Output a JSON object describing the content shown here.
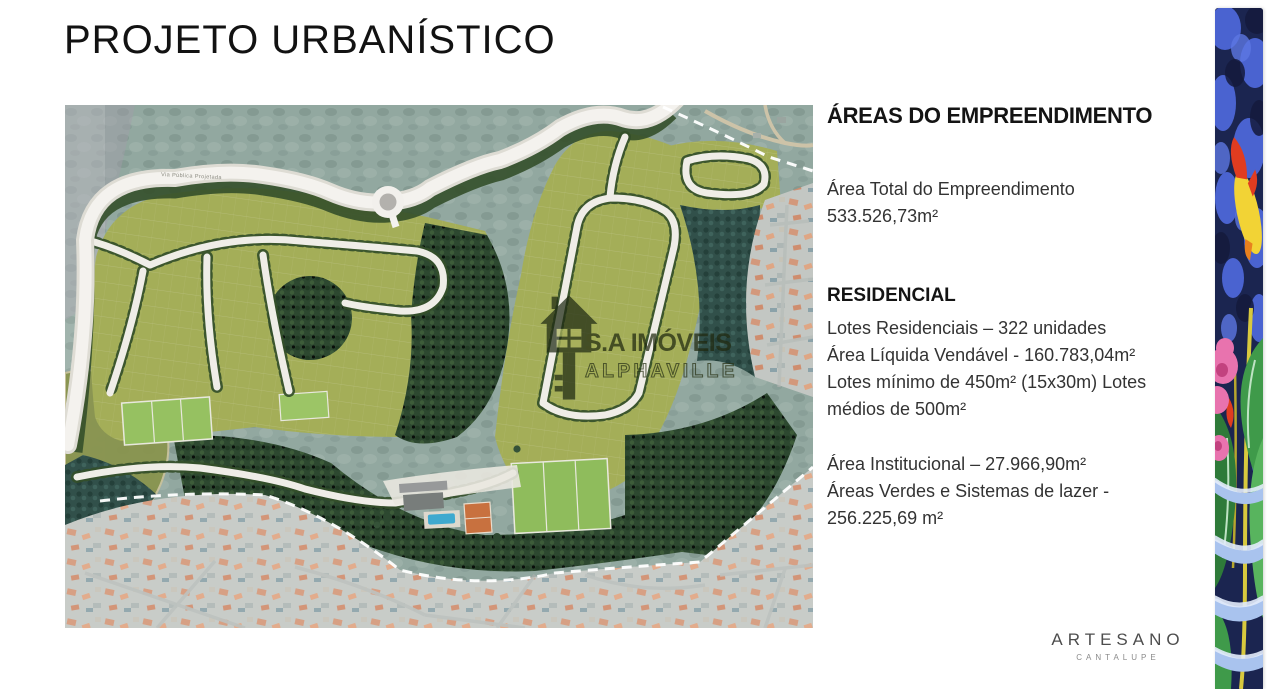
{
  "title": "PROJETO URBANÍSTICO",
  "panel": {
    "heading": "ÁREAS DO EMPREENDIMENTO",
    "total": {
      "label": "Área Total do Empreendimento",
      "value": "533.526,73m²"
    },
    "residencial": {
      "heading": "RESIDENCIAL",
      "line1": "Lotes Residenciais – 322 unidades",
      "line2": "Área Líquida Vendável - 160.783,04m²",
      "line3": "Lotes mínimo de 450m² (15x30m) Lotes médios de 500m²"
    },
    "outras": {
      "line1": "Área Institucional – 27.966,90m²",
      "line2": "Áreas Verdes e Sistemas de lazer - 256.225,69 m²"
    }
  },
  "map": {
    "road_label": "Via Pública Projetada",
    "watermark_line1": "S.A IMÓVEIS",
    "watermark_line2": "ALPHAVILLE"
  },
  "brand": {
    "name": "ARTESANO",
    "tagline": "CANTALUPE"
  },
  "colors": {
    "development_green": "#a4ae58",
    "field_green": "#8fbc5c",
    "forest_green": "#2d4830",
    "terrain_teal": "#92a8a0",
    "road_white": "#f4f2ee",
    "roof_orange": "#c97f5a",
    "pool_blue": "#3fa9cf",
    "court_orange": "#c8713f",
    "strip_blue": "#4a63d0",
    "strip_navy": "#1b2550",
    "flower_pink": "#e873ae",
    "flower_yellow": "#f2d335"
  }
}
